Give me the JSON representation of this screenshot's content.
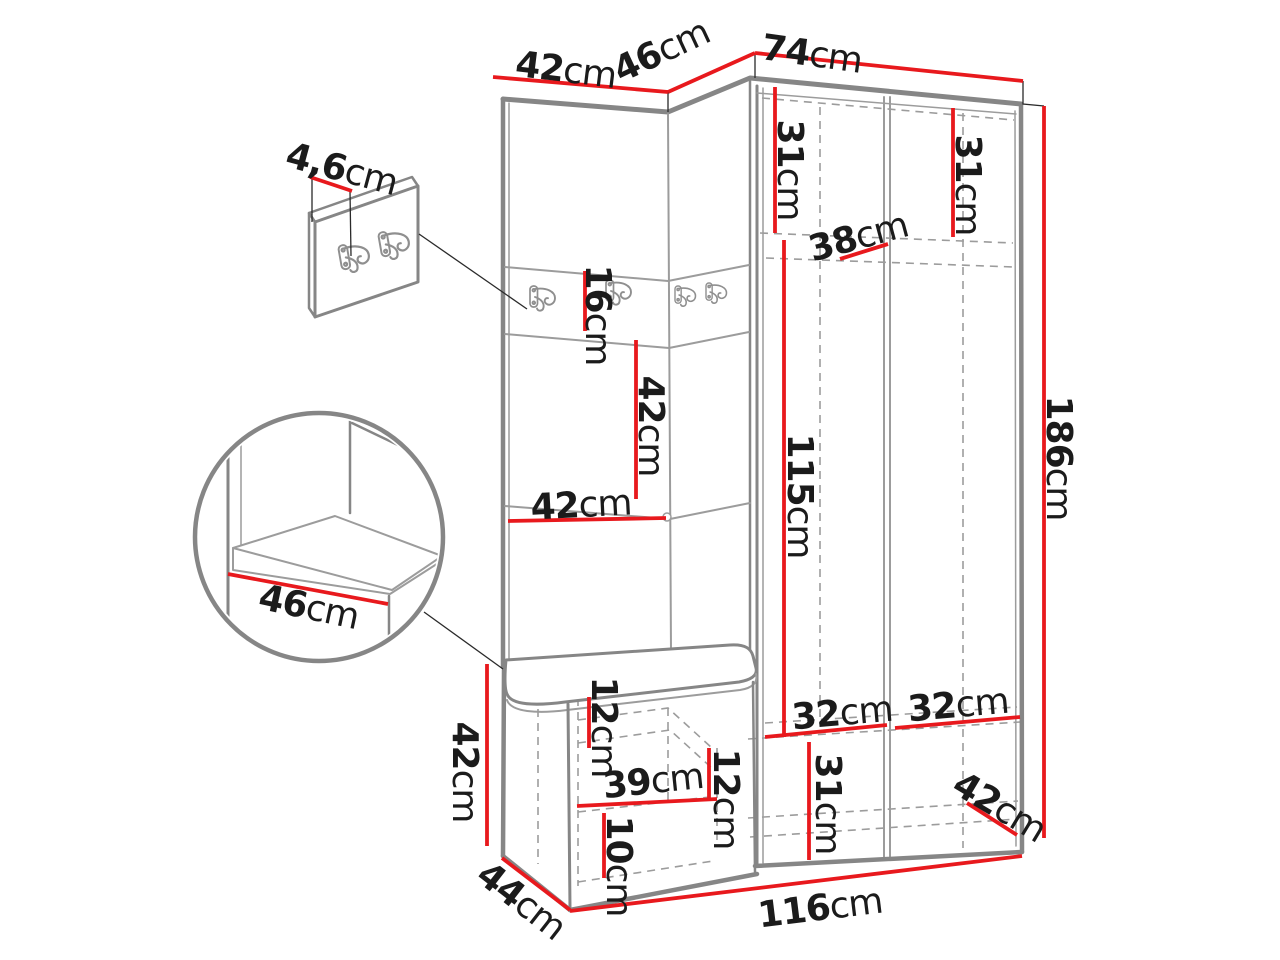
{
  "diagram": {
    "kind": "furniture dimension drawing",
    "subject": "corner hallway wardrobe set with coat-hook panels and storage bench",
    "unit": "cm"
  },
  "colors": {
    "dimension_red": "#e8191d",
    "outline_gray": "#868686",
    "seam_gray": "#9c9c9c",
    "text_black": "#1b1b1b",
    "background": "#ffffff"
  },
  "icons": {
    "coat_hook": "double-prong coat hook"
  },
  "dims": {
    "top_left_width": {
      "value": "42",
      "unit": "cm"
    },
    "top_corner_width": {
      "value": "46",
      "unit": "cm"
    },
    "top_right_width": {
      "value": "74",
      "unit": "cm"
    },
    "hook_panel_thickness": {
      "value": "4,6",
      "unit": "cm"
    },
    "left_upper_section_height": {
      "value": "31",
      "unit": "cm"
    },
    "right_upper_section_height": {
      "value": "31",
      "unit": "cm"
    },
    "upper_shelf_depth": {
      "value": "38",
      "unit": "cm"
    },
    "hook_strip_height": {
      "value": "16",
      "unit": "cm"
    },
    "mid_panel_height": {
      "value": "42",
      "unit": "cm"
    },
    "mid_panel_width": {
      "value": "42",
      "unit": "cm"
    },
    "hanging_space_height": {
      "value": "115",
      "unit": "cm"
    },
    "total_height": {
      "value": "186",
      "unit": "cm"
    },
    "seat_depth_detail": {
      "value": "46",
      "unit": "cm"
    },
    "bench_height": {
      "value": "42",
      "unit": "cm"
    },
    "bench_top_gap_height": {
      "value": "12",
      "unit": "cm"
    },
    "bench_shelf_width": {
      "value": "39",
      "unit": "cm"
    },
    "bench_mid_gap_height": {
      "value": "12",
      "unit": "cm"
    },
    "bench_bottom_gap_height": {
      "value": "10",
      "unit": "cm"
    },
    "bench_depth": {
      "value": "44",
      "unit": "cm"
    },
    "total_width": {
      "value": "116",
      "unit": "cm"
    },
    "left_shelf_width": {
      "value": "32",
      "unit": "cm"
    },
    "right_shelf_width": {
      "value": "32",
      "unit": "cm"
    },
    "bottom_section_height": {
      "value": "31",
      "unit": "cm"
    },
    "wardrobe_depth": {
      "value": "42",
      "unit": "cm"
    }
  }
}
